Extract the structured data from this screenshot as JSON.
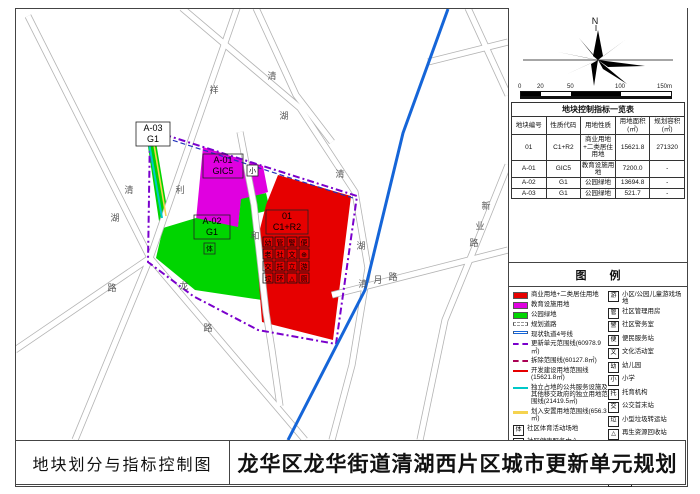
{
  "title_bar": {
    "left": "地块划分与指标控制图",
    "right": "龙华区龙华街道清湖西片区城市更新单元规划"
  },
  "north_label": "N",
  "scale": {
    "ticks": [
      "0",
      "20",
      "50",
      "100",
      "150m"
    ]
  },
  "colors": {
    "commercial_red": "#e60000",
    "education_magenta": "#e000e0",
    "park_green": "#00d500",
    "unit_boundary_purple": "#7a00cc",
    "demolition_line": "#aa0055",
    "metro_blue": "#1565d8",
    "independent_cyan": "#00c8c8",
    "resettlement_yellow": "#f5d34f"
  },
  "table": {
    "title": "地块控制指标一览表",
    "headers": [
      "地块编号",
      "性质代码",
      "用地性质",
      "用地面积(㎡)",
      "规划容积(㎡)"
    ],
    "rows": [
      [
        "01",
        "C1+R2",
        "商业用地+二类居住用地",
        "15621.8",
        "271320"
      ],
      [
        "A-01",
        "GIC5",
        "教育设施用地",
        "7200.0",
        "-"
      ],
      [
        "A-02",
        "G1",
        "公园绿地",
        "13694.8",
        "-"
      ],
      [
        "A-03",
        "G1",
        "公园绿地",
        "521.7",
        "-"
      ]
    ]
  },
  "legend": {
    "title": "图  例",
    "left": [
      {
        "label": "商业用地+二类居住用地"
      },
      {
        "label": "教育设施用地"
      },
      {
        "label": "公园绿地"
      },
      {
        "label": "规划道路"
      },
      {
        "label": "现状轨道4号线"
      },
      {
        "label": "更新单元范围线(60978.9㎡)"
      },
      {
        "label": "拆除范围线(60127.8㎡)"
      },
      {
        "label": "开发建设用地范围线(15621.8㎡)"
      },
      {
        "label": "独立占地的公共服务设施及其他移交政府的独立用地范围线(21419.5㎡)"
      },
      {
        "label": "划入安置用地范围线(656.3㎡)"
      },
      {
        "icon": "体",
        "label": "社区体育活动场地"
      },
      {
        "icon": "⊕",
        "label": "社区健康服务中心"
      },
      {
        "icon": "社",
        "label": "社区级公共配套用房"
      },
      {
        "icon": "老",
        "label": "社区老年人日间照料中心"
      }
    ],
    "right": [
      {
        "icon": "游",
        "label": "小区/公园儿童游戏场地"
      },
      {
        "icon": "管",
        "label": "社区管理用房"
      },
      {
        "icon": "警",
        "label": "社区警务室"
      },
      {
        "icon": "便",
        "label": "便民服务站"
      },
      {
        "icon": "文",
        "label": "文化活动室"
      },
      {
        "icon": "幼",
        "label": "幼儿园"
      },
      {
        "icon": "小",
        "label": "小学"
      },
      {
        "icon": "托",
        "label": "托育机构"
      },
      {
        "icon": "交",
        "label": "公交首末站"
      },
      {
        "icon": "垃",
        "label": "小型垃圾转运站"
      },
      {
        "icon": "△",
        "label": "再生资源回收站"
      },
      {
        "icon": "厕",
        "label": "公共厕所"
      },
      {
        "icon": "环",
        "label": "环卫工人休息房"
      },
      {
        "icon_top": "01",
        "icon_bottom": "C1+R2",
        "label": "地块编号 用地性质代码"
      }
    ]
  },
  "map": {
    "plots": [
      {
        "id": "01",
        "code": "C1+R2"
      },
      {
        "id": "A-01",
        "code": "GIC5",
        "badge": "小"
      },
      {
        "id": "A-02",
        "code": "G1",
        "badge": "体"
      },
      {
        "id": "A-03",
        "code": "G1"
      }
    ],
    "facility_grid": [
      [
        "幼",
        "管",
        "警",
        "便"
      ],
      [
        "老",
        "社",
        "文",
        "⊕"
      ],
      [
        "交",
        "托",
        "立",
        "游"
      ],
      [
        "垃",
        "环",
        "△",
        "厕"
      ]
    ],
    "road_labels": [
      {
        "t": "清"
      },
      {
        "t": "湖"
      },
      {
        "t": "路"
      },
      {
        "t": "祥"
      },
      {
        "t": "利"
      },
      {
        "t": "清"
      },
      {
        "t": "湖"
      },
      {
        "t": "和"
      },
      {
        "t": "龙"
      },
      {
        "t": "路"
      },
      {
        "t": "清"
      },
      {
        "t": "湖"
      },
      {
        "t": "清"
      },
      {
        "t": "月"
      },
      {
        "t": "路"
      },
      {
        "t": "新"
      },
      {
        "t": "业"
      },
      {
        "t": "路"
      }
    ]
  }
}
